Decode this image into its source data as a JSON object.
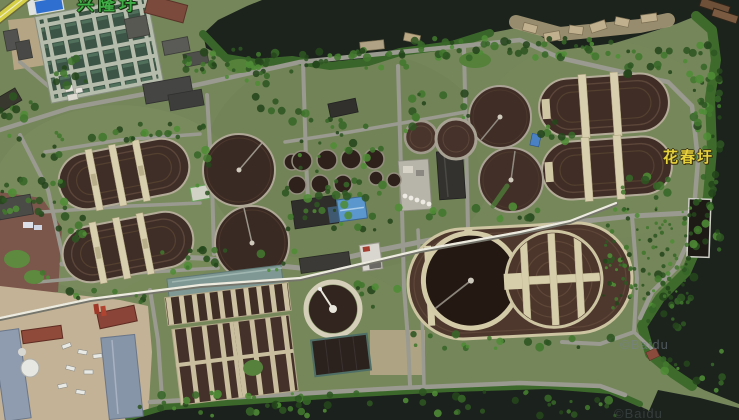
{
  "map": {
    "view_type": "satellite",
    "place_labels": [
      {
        "id": "top",
        "text": "兴隆圩",
        "color": "#3fae46",
        "partially_visible": true
      },
      {
        "id": "right",
        "text": "花春圩",
        "color": "#e8d23c",
        "partially_visible": false
      }
    ],
    "watermarks": [
      {
        "id": "center",
        "text": "©Baidu"
      },
      {
        "id": "corner",
        "text": "©Baidu"
      }
    ],
    "palette": {
      "river_water": "#1c231d",
      "grass_base": "#74865a",
      "vegetation_bright": "#4f8c36",
      "vegetation_dark": "#24451b",
      "road_gray": "#9a9a90",
      "pipeline_white": "#edebe0",
      "walkway_concrete": "#d6cdaa",
      "basin_brown": "#3a2a24",
      "basin_deep_dark": "#241813",
      "filter_cell_teal": "#3c5446",
      "pool_blue": "#2f6fd0",
      "roof_blue": "#5b96cc",
      "roof_red": "#8a4438",
      "plaza_brick": "#7b564b",
      "dirt_tan": "#c3b296"
    }
  }
}
